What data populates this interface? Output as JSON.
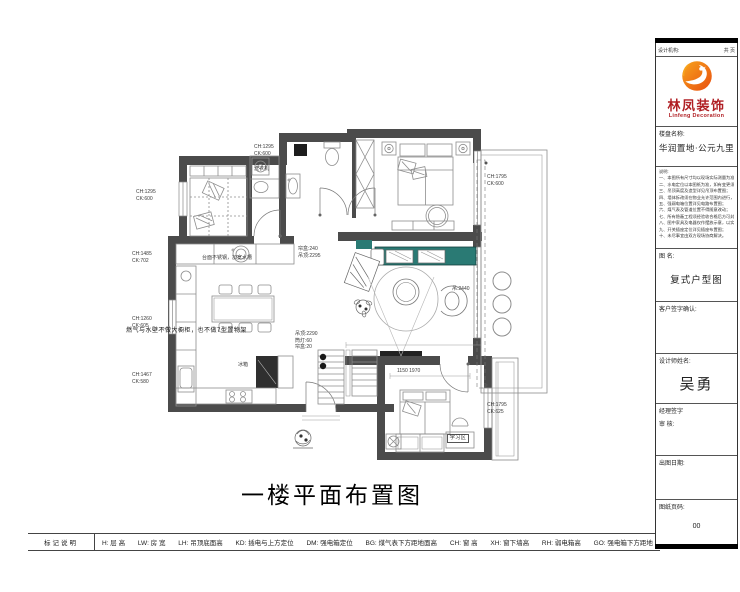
{
  "plan": {
    "title": "一楼平面布置图",
    "colors": {
      "wall": "#4b4b4b",
      "teal": "#2a7a74",
      "tv": "#222222"
    },
    "annotations": [
      {
        "text": "CH:1295\nCK:600"
      },
      {
        "text": "CH:1485\nCK:702"
      },
      {
        "text": "CH:1260\nCK:605"
      },
      {
        "text": "CH:1467\nCK:580"
      },
      {
        "text": "CH:1295\nCK:600"
      },
      {
        "text": "CH:1795\nCK:600"
      },
      {
        "text": "CH:1795\nCK:625"
      },
      {
        "text": "帘盒:240\n吊顶:2295"
      },
      {
        "text": "吊顶:2290\n筒灯:60\n帘盒:20"
      },
      {
        "text": "吊:2440"
      },
      {
        "text": "燃气与水壁不做大橱柜，也不做7型置物架"
      },
      {
        "text": "台面不锈钢，加宽水槽"
      },
      {
        "text": "洗衣机"
      },
      {
        "text": "学习区"
      },
      {
        "text": "冰箱"
      },
      {
        "text": "1150  1970"
      }
    ]
  },
  "legend": {
    "header": "标记说明",
    "items": [
      "H: 层  高",
      "LW: 房  宽",
      "LH: 吊顶底面高",
      "KD: 插电与上方定位",
      "DM: 强电箱定位",
      "BG: 煤气表下方距地面高",
      "CH: 窗  高",
      "XH: 窗下墙高",
      "RH: 弱电箱高",
      "GO: 强电箱下方距地"
    ]
  },
  "title_block": {
    "header_left": "设计机构:",
    "header_right": "共 页",
    "logo": {
      "name_cn": "林凤装饰",
      "name_en": "Linfeng Decoration"
    },
    "project_label": "楼盘名称:",
    "project_name": "华润置地·公元九里",
    "notes": [
      "说明:",
      "一、本图所有尺寸均以现场实际测量为准，施工前请仔细核对；",
      "二、水电定位以本图纸为准，如有变更须经设计师确认；",
      "三、吊顶高度及造型详见吊顶布置图；",
      "四、墙体拆改须在物业允许范围内进行，不得拆动承重墙；",
      "五、强弱电箱位置详见电路布置图；",
      "六、煤气表及管道位置不得随意改动；",
      "七、所有隐蔽工程须经验收合格后方可封闭；",
      "八、图中家具及电器仅作摆放示意，以实际采购为准；",
      "九、开关插座定位详见插座布置图；",
      "十、未尽事宜由双方现场协商解决。"
    ],
    "drawing_name_label": "图 名:",
    "drawing_name": "复式户型图",
    "client_sign_label": "客户签字确认:",
    "designer_label": "设计师姓名:",
    "designer_name": "吴勇",
    "manager_sign_label": "经理签字",
    "review_label": "审  核:",
    "date_label": "出图日期:",
    "page_label": "图纸页码:",
    "page_number": "00"
  }
}
